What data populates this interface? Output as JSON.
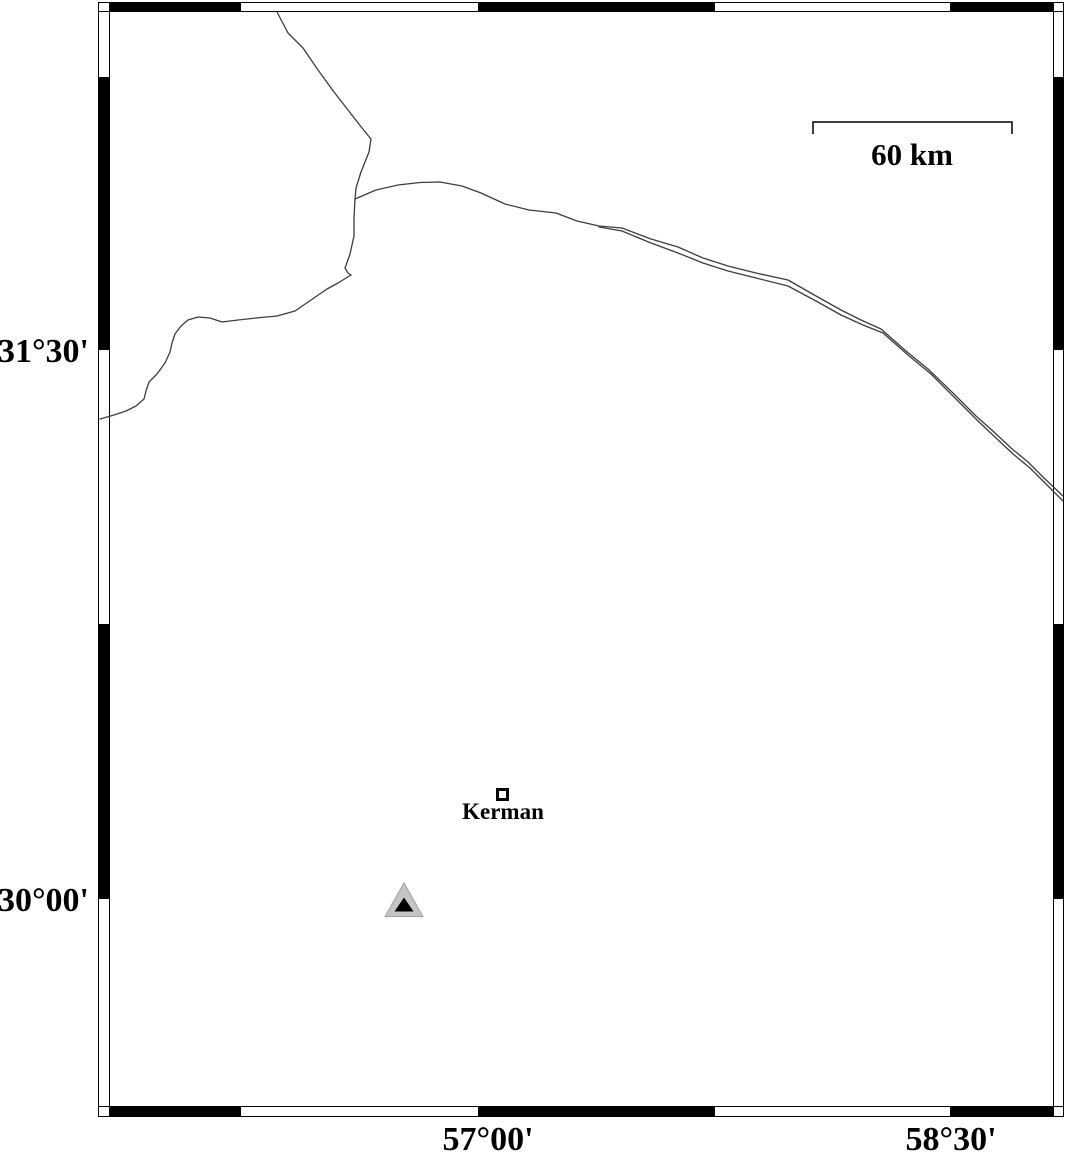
{
  "map": {
    "axis_labels": {
      "lat_upper": "31°30'",
      "lat_lower": "30°00'",
      "lon_left": "57°00'",
      "lon_right": "58°30'"
    },
    "scale_bar": {
      "label": "60 km"
    },
    "markers": {
      "city": {
        "label": "Kerman",
        "symbol": "open-square",
        "outline_color": "#000000",
        "fill_color": "#ffffff"
      },
      "station": {
        "symbol": "filled-triangle",
        "outer_color": "#c5c5c5",
        "outer_edge_color": "#a0a0a0",
        "inner_color": "#000000"
      }
    },
    "colors": {
      "background": "#ffffff",
      "frame": "#000000",
      "boundary_line": "#3d3d3d"
    }
  }
}
